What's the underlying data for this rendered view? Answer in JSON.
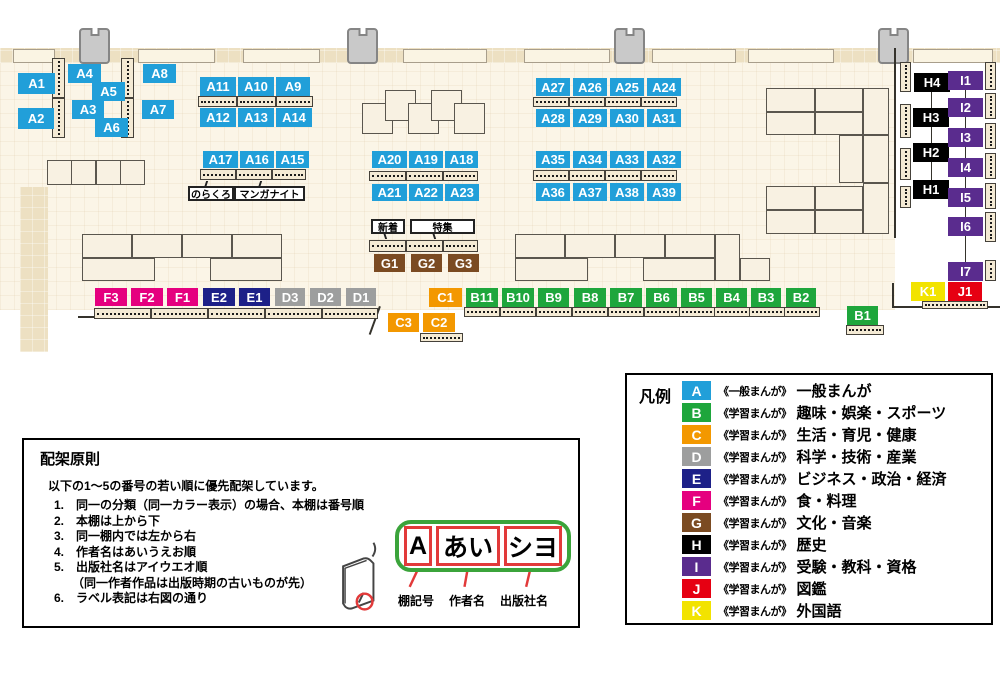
{
  "colors": {
    "A": "#219FD9",
    "B": "#1EA63C",
    "C": "#F39800",
    "D": "#9D9E9E",
    "E": "#1D2088",
    "F": "#E5007F",
    "G": "#7B4B22",
    "H": "#000000",
    "I": "#5A2C8E",
    "J": "#E60012",
    "K": "#F2E300"
  },
  "map": {
    "bands": [
      [
        0,
        48,
        1000,
        15
      ],
      [
        20,
        187,
        28,
        165
      ]
    ],
    "doors": [
      [
        13,
        49,
        42,
        14
      ],
      [
        138,
        49,
        77,
        14
      ],
      [
        243,
        49,
        77,
        14
      ],
      [
        403,
        49,
        84,
        14
      ],
      [
        524,
        49,
        86,
        14
      ],
      [
        652,
        49,
        84,
        14
      ],
      [
        748,
        49,
        86,
        14
      ],
      [
        913,
        49,
        80,
        14
      ]
    ],
    "pillars": [
      79,
      347,
      614,
      878
    ],
    "blocks": [
      [
        47,
        160,
        25,
        25
      ],
      [
        71,
        160,
        25,
        25
      ],
      [
        96,
        160,
        25,
        25
      ],
      [
        120,
        160,
        25,
        25
      ],
      [
        362,
        103,
        31,
        31
      ],
      [
        385,
        90,
        31,
        31
      ],
      [
        408,
        103,
        31,
        31
      ],
      [
        431,
        90,
        31,
        31
      ],
      [
        454,
        103,
        31,
        31
      ],
      [
        82,
        234,
        50,
        24
      ],
      [
        132,
        234,
        50,
        24
      ],
      [
        182,
        234,
        50,
        24
      ],
      [
        232,
        234,
        50,
        24
      ],
      [
        82,
        258,
        73,
        23
      ],
      [
        210,
        258,
        72,
        23
      ],
      [
        515,
        234,
        50,
        24
      ],
      [
        565,
        234,
        50,
        24
      ],
      [
        615,
        234,
        50,
        24
      ],
      [
        665,
        234,
        50,
        24
      ],
      [
        515,
        258,
        73,
        23
      ],
      [
        643,
        258,
        72,
        23
      ],
      [
        715,
        234,
        25,
        47
      ],
      [
        740,
        258,
        30,
        23
      ],
      [
        766,
        88,
        49,
        24
      ],
      [
        815,
        88,
        48,
        24
      ],
      [
        863,
        88,
        26,
        47
      ],
      [
        766,
        112,
        49,
        23
      ],
      [
        815,
        112,
        48,
        23
      ],
      [
        839,
        135,
        24,
        48
      ],
      [
        863,
        135,
        26,
        48
      ],
      [
        766,
        186,
        49,
        24
      ],
      [
        815,
        186,
        48,
        24
      ],
      [
        863,
        183,
        26,
        51
      ],
      [
        766,
        210,
        49,
        24
      ],
      [
        815,
        210,
        48,
        24
      ]
    ],
    "shelves": [
      [
        198,
        96,
        39,
        11
      ],
      [
        237,
        96,
        39,
        11
      ],
      [
        276,
        96,
        37,
        11
      ],
      [
        200,
        169,
        36,
        11
      ],
      [
        236,
        169,
        36,
        11
      ],
      [
        272,
        169,
        34,
        11
      ],
      [
        369,
        171,
        37,
        10
      ],
      [
        406,
        171,
        37,
        10
      ],
      [
        443,
        171,
        35,
        10
      ],
      [
        533,
        97,
        36,
        10
      ],
      [
        569,
        97,
        36,
        10
      ],
      [
        605,
        97,
        36,
        10
      ],
      [
        641,
        97,
        36,
        10
      ],
      [
        533,
        170,
        36,
        11
      ],
      [
        569,
        170,
        36,
        11
      ],
      [
        605,
        170,
        36,
        11
      ],
      [
        641,
        170,
        36,
        11
      ],
      [
        369,
        240,
        37,
        12
      ],
      [
        406,
        240,
        37,
        12
      ],
      [
        443,
        240,
        35,
        12
      ],
      [
        94,
        308,
        57,
        11
      ],
      [
        151,
        308,
        57,
        11
      ],
      [
        208,
        308,
        57,
        11
      ],
      [
        265,
        308,
        57,
        11
      ],
      [
        322,
        308,
        56,
        11
      ],
      [
        464,
        307,
        36,
        10
      ],
      [
        500,
        307,
        36,
        10
      ],
      [
        536,
        307,
        36,
        10
      ],
      [
        572,
        307,
        36,
        10
      ],
      [
        608,
        307,
        36,
        10
      ],
      [
        644,
        307,
        36,
        10
      ],
      [
        679,
        307,
        36,
        10
      ],
      [
        714,
        307,
        36,
        10
      ],
      [
        749,
        307,
        36,
        10
      ],
      [
        784,
        307,
        36,
        10
      ],
      [
        420,
        333,
        43,
        9
      ],
      [
        846,
        325,
        38,
        10
      ],
      [
        922,
        301,
        66,
        8
      ],
      [
        52,
        58,
        13,
        40,
        "v"
      ],
      [
        52,
        98,
        13,
        40,
        "v"
      ],
      [
        121,
        58,
        13,
        40,
        "v"
      ],
      [
        121,
        98,
        13,
        40,
        "v"
      ],
      [
        900,
        62,
        11,
        30,
        "v"
      ],
      [
        900,
        104,
        11,
        34,
        "v"
      ],
      [
        900,
        148,
        11,
        32,
        "v"
      ],
      [
        900,
        186,
        11,
        22,
        "v"
      ],
      [
        985,
        62,
        11,
        28,
        "v"
      ],
      [
        985,
        93,
        11,
        26,
        "v"
      ],
      [
        985,
        123,
        11,
        26,
        "v"
      ],
      [
        985,
        153,
        11,
        26,
        "v"
      ],
      [
        985,
        183,
        11,
        26,
        "v"
      ],
      [
        985,
        212,
        11,
        30,
        "v"
      ],
      [
        985,
        260,
        11,
        21,
        "v"
      ]
    ],
    "lines": [
      [
        894,
        48,
        2,
        190
      ],
      [
        892,
        283,
        2,
        25
      ],
      [
        892,
        306,
        108,
        2
      ],
      [
        78,
        316,
        17,
        2
      ],
      [
        931,
        82,
        1,
        110
      ],
      [
        965,
        80,
        1,
        192
      ],
      [
        379,
        306,
        2,
        30,
        20
      ]
    ],
    "chips": [
      [
        "A1",
        "A",
        18,
        73,
        37,
        21
      ],
      [
        "A2",
        "A",
        18,
        108,
        36,
        21
      ],
      [
        "A4",
        "A",
        68,
        64,
        33,
        19
      ],
      [
        "A5",
        "A",
        92,
        82,
        33,
        19
      ],
      [
        "A3",
        "A",
        72,
        100,
        32,
        19
      ],
      [
        "A6",
        "A",
        95,
        118,
        33,
        19
      ],
      [
        "A8",
        "A",
        143,
        64,
        33,
        19
      ],
      [
        "A7",
        "A",
        142,
        100,
        32,
        19
      ],
      [
        "A11",
        "A",
        200,
        77,
        36,
        19
      ],
      [
        "A10",
        "A",
        238,
        77,
        36,
        19
      ],
      [
        "A9",
        "A",
        276,
        77,
        34,
        19
      ],
      [
        "A12",
        "A",
        200,
        108,
        36,
        19
      ],
      [
        "A13",
        "A",
        238,
        108,
        36,
        19
      ],
      [
        "A14",
        "A",
        276,
        108,
        36,
        19
      ],
      [
        "A17",
        "A",
        203,
        151,
        35,
        17
      ],
      [
        "A16",
        "A",
        240,
        151,
        34,
        17
      ],
      [
        "A15",
        "A",
        276,
        151,
        33,
        17
      ],
      [
        "A20",
        "A",
        372,
        151,
        35,
        17
      ],
      [
        "A19",
        "A",
        409,
        151,
        34,
        17
      ],
      [
        "A18",
        "A",
        445,
        151,
        33,
        17
      ],
      [
        "A21",
        "A",
        372,
        184,
        35,
        17
      ],
      [
        "A22",
        "A",
        409,
        184,
        34,
        17
      ],
      [
        "A23",
        "A",
        445,
        184,
        34,
        17
      ],
      [
        "A27",
        "A",
        536,
        78,
        34,
        18
      ],
      [
        "A26",
        "A",
        573,
        78,
        34,
        18
      ],
      [
        "A25",
        "A",
        610,
        78,
        34,
        18
      ],
      [
        "A24",
        "A",
        647,
        78,
        34,
        18
      ],
      [
        "A28",
        "A",
        536,
        109,
        34,
        18
      ],
      [
        "A29",
        "A",
        573,
        109,
        34,
        18
      ],
      [
        "A30",
        "A",
        610,
        109,
        34,
        18
      ],
      [
        "A31",
        "A",
        647,
        109,
        34,
        18
      ],
      [
        "A35",
        "A",
        536,
        151,
        34,
        17
      ],
      [
        "A34",
        "A",
        573,
        151,
        34,
        17
      ],
      [
        "A33",
        "A",
        610,
        151,
        34,
        17
      ],
      [
        "A32",
        "A",
        647,
        151,
        34,
        17
      ],
      [
        "A36",
        "A",
        536,
        183,
        34,
        18
      ],
      [
        "A37",
        "A",
        573,
        183,
        34,
        18
      ],
      [
        "A38",
        "A",
        610,
        183,
        34,
        18
      ],
      [
        "A39",
        "A",
        647,
        183,
        34,
        18
      ],
      [
        "G1",
        "G",
        374,
        254,
        31,
        18
      ],
      [
        "G2",
        "G",
        411,
        254,
        31,
        18
      ],
      [
        "G3",
        "G",
        448,
        254,
        31,
        18
      ],
      [
        "F3",
        "F",
        95,
        288,
        32,
        18
      ],
      [
        "F2",
        "F",
        131,
        288,
        32,
        18
      ],
      [
        "F1",
        "F",
        167,
        288,
        31,
        18
      ],
      [
        "E2",
        "E",
        203,
        288,
        32,
        18
      ],
      [
        "E1",
        "E",
        239,
        288,
        31,
        18
      ],
      [
        "D3",
        "D",
        275,
        288,
        30,
        18
      ],
      [
        "D2",
        "D",
        310,
        288,
        31,
        18
      ],
      [
        "D1",
        "D",
        346,
        288,
        30,
        18
      ],
      [
        "C1",
        "C",
        429,
        288,
        33,
        19
      ],
      [
        "C3",
        "C",
        388,
        313,
        31,
        19
      ],
      [
        "C2",
        "C",
        423,
        313,
        32,
        19
      ],
      [
        "B11",
        "B",
        466,
        288,
        32,
        19
      ],
      [
        "B10",
        "B",
        502,
        288,
        32,
        19
      ],
      [
        "B9",
        "B",
        538,
        288,
        31,
        19
      ],
      [
        "B8",
        "B",
        574,
        288,
        32,
        19
      ],
      [
        "B7",
        "B",
        610,
        288,
        32,
        19
      ],
      [
        "B6",
        "B",
        646,
        288,
        31,
        19
      ],
      [
        "B5",
        "B",
        681,
        288,
        31,
        19
      ],
      [
        "B4",
        "B",
        716,
        288,
        31,
        19
      ],
      [
        "B3",
        "B",
        751,
        288,
        30,
        19
      ],
      [
        "B2",
        "B",
        786,
        288,
        30,
        19
      ],
      [
        "B1",
        "B",
        847,
        306,
        31,
        19
      ],
      [
        "H4",
        "H",
        914,
        73,
        36,
        19
      ],
      [
        "H3",
        "H",
        913,
        108,
        36,
        19
      ],
      [
        "H2",
        "H",
        913,
        143,
        36,
        19
      ],
      [
        "H1",
        "H",
        913,
        180,
        36,
        19
      ],
      [
        "I1",
        "I",
        948,
        71,
        35,
        19
      ],
      [
        "I2",
        "I",
        948,
        98,
        35,
        19
      ],
      [
        "I3",
        "I",
        948,
        128,
        35,
        19
      ],
      [
        "I4",
        "I",
        948,
        158,
        35,
        19
      ],
      [
        "I5",
        "I",
        948,
        188,
        35,
        19
      ],
      [
        "I6",
        "I",
        948,
        217,
        35,
        19
      ],
      [
        "I7",
        "I",
        948,
        262,
        35,
        19
      ],
      [
        "K1",
        "K",
        911,
        282,
        34,
        19
      ],
      [
        "J1",
        "J",
        948,
        282,
        34,
        19
      ]
    ],
    "callouts": [
      [
        "のらくろ",
        188,
        186,
        46,
        15,
        "up"
      ],
      [
        "マンガナイト",
        234,
        186,
        71,
        15,
        "up"
      ],
      [
        "新着",
        371,
        219,
        34,
        15,
        "down"
      ],
      [
        "特集",
        410,
        219,
        65,
        15,
        "down"
      ]
    ]
  },
  "legend": {
    "title": "凡例",
    "items": [
      {
        "letter": "A",
        "series": "《一般まんが》",
        "category": "一般まんが"
      },
      {
        "letter": "B",
        "series": "《学習まんが》",
        "category": "趣味・娯楽・スポーツ"
      },
      {
        "letter": "C",
        "series": "《学習まんが》",
        "category": "生活・育児・健康"
      },
      {
        "letter": "D",
        "series": "《学習まんが》",
        "category": "科学・技術・産業"
      },
      {
        "letter": "E",
        "series": "《学習まんが》",
        "category": "ビジネス・政治・経済"
      },
      {
        "letter": "F",
        "series": "《学習まんが》",
        "category": "食・料理"
      },
      {
        "letter": "G",
        "series": "《学習まんが》",
        "category": "文化・音楽"
      },
      {
        "letter": "H",
        "series": "《学習まんが》",
        "category": "歴史"
      },
      {
        "letter": "I",
        "series": "《学習まんが》",
        "category": "受験・教科・資格"
      },
      {
        "letter": "J",
        "series": "《学習まんが》",
        "category": "図鑑"
      },
      {
        "letter": "K",
        "series": "《学習まんが》",
        "category": "外国語"
      }
    ]
  },
  "principles": {
    "title": "配架原則",
    "intro": "以下の1～5の番号の若い順に優先配架しています。",
    "items": [
      "1.　同一の分類（同一カラー表示）の場合、本棚は番号順",
      "2.　本棚は上から下",
      "3.　同一棚内では左から右",
      "4.　作者名はあいうえお順",
      "5.　出版社名はアイウエオ順",
      "　　（同一作者作品は出版時期の古いものが先）",
      "6.　ラベル表記は右図の通り"
    ],
    "label_diagram": {
      "boxes": [
        {
          "text": "A",
          "w": 28
        },
        {
          "text": "あい",
          "w": 64
        },
        {
          "text": "シヨ",
          "w": 58
        }
      ],
      "annotations": [
        "棚記号",
        "作者名",
        "出版社名"
      ]
    }
  }
}
